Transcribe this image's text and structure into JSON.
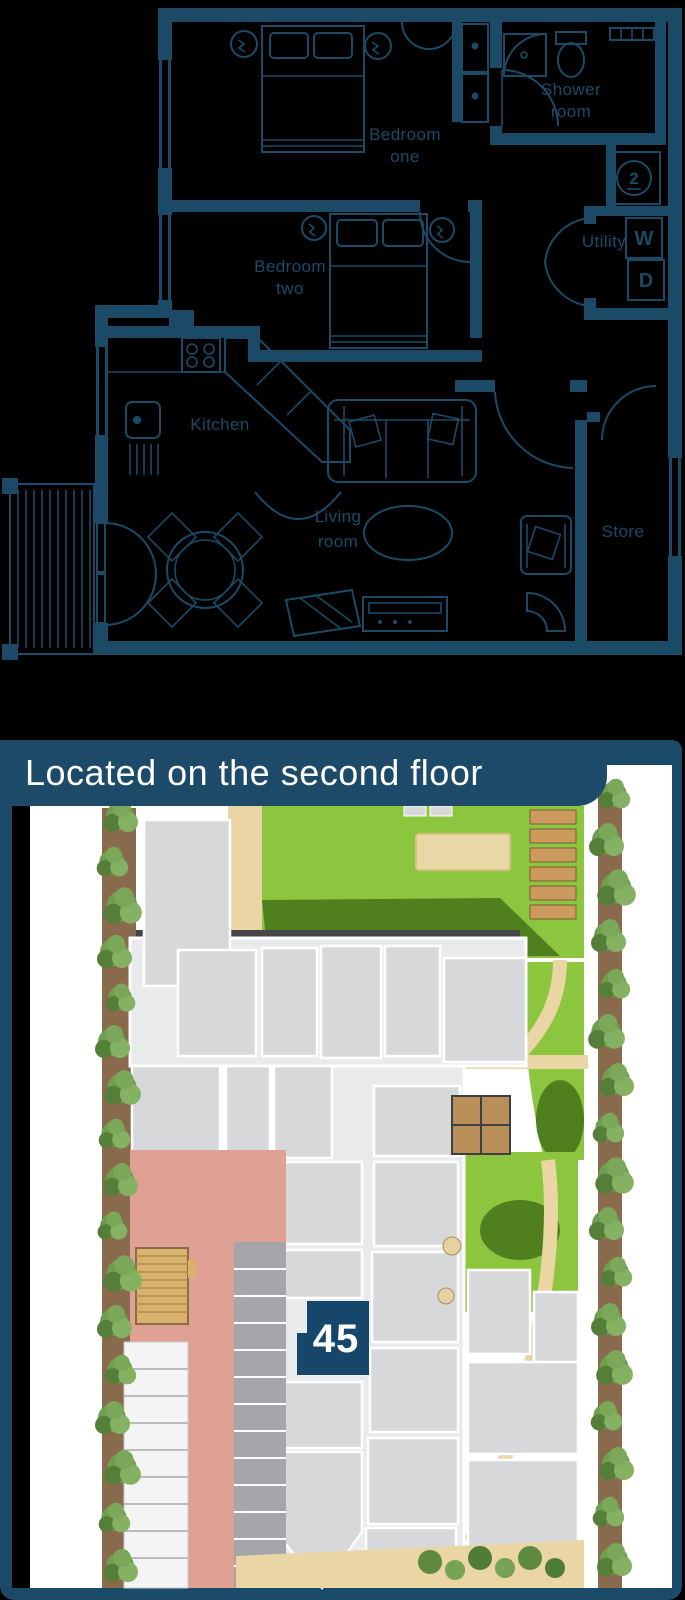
{
  "banner": {
    "text": "Located on the second floor"
  },
  "floor_plan": {
    "rooms": {
      "bedroom_one": {
        "line1": "Bedroom",
        "line2": "one"
      },
      "bedroom_two": {
        "line1": "Bedroom",
        "line2": "two"
      },
      "shower_room": {
        "line1": "Shower",
        "line2": "room"
      },
      "utility": {
        "label": "Utility"
      },
      "kitchen": {
        "label": "Kitchen"
      },
      "living_room": {
        "line1": "Living",
        "line2": "room"
      },
      "store": {
        "label": "Store"
      }
    },
    "appliances": {
      "washer": "W",
      "dryer": "D",
      "cylinder": "2"
    }
  },
  "site_plan": {
    "unit_marker": "45"
  },
  "colors": {
    "page_background": "#000000",
    "plan_navy": "#1b4a66",
    "banner_navy": "#1d4a68",
    "marker_navy": "#17466b",
    "lawn_green": "#8cc63f",
    "shadow_green": "#447318",
    "path_tan": "#e9d6a4",
    "road_pink": "#e0a195",
    "building_gray": "#d7d8da",
    "building_light": "#e9eaec",
    "parking_gray": "#a6a6aa",
    "deck_tan": "#d9b26c",
    "mulch_brown": "#8a6a4d",
    "tree_green": "#6f9e4e"
  }
}
